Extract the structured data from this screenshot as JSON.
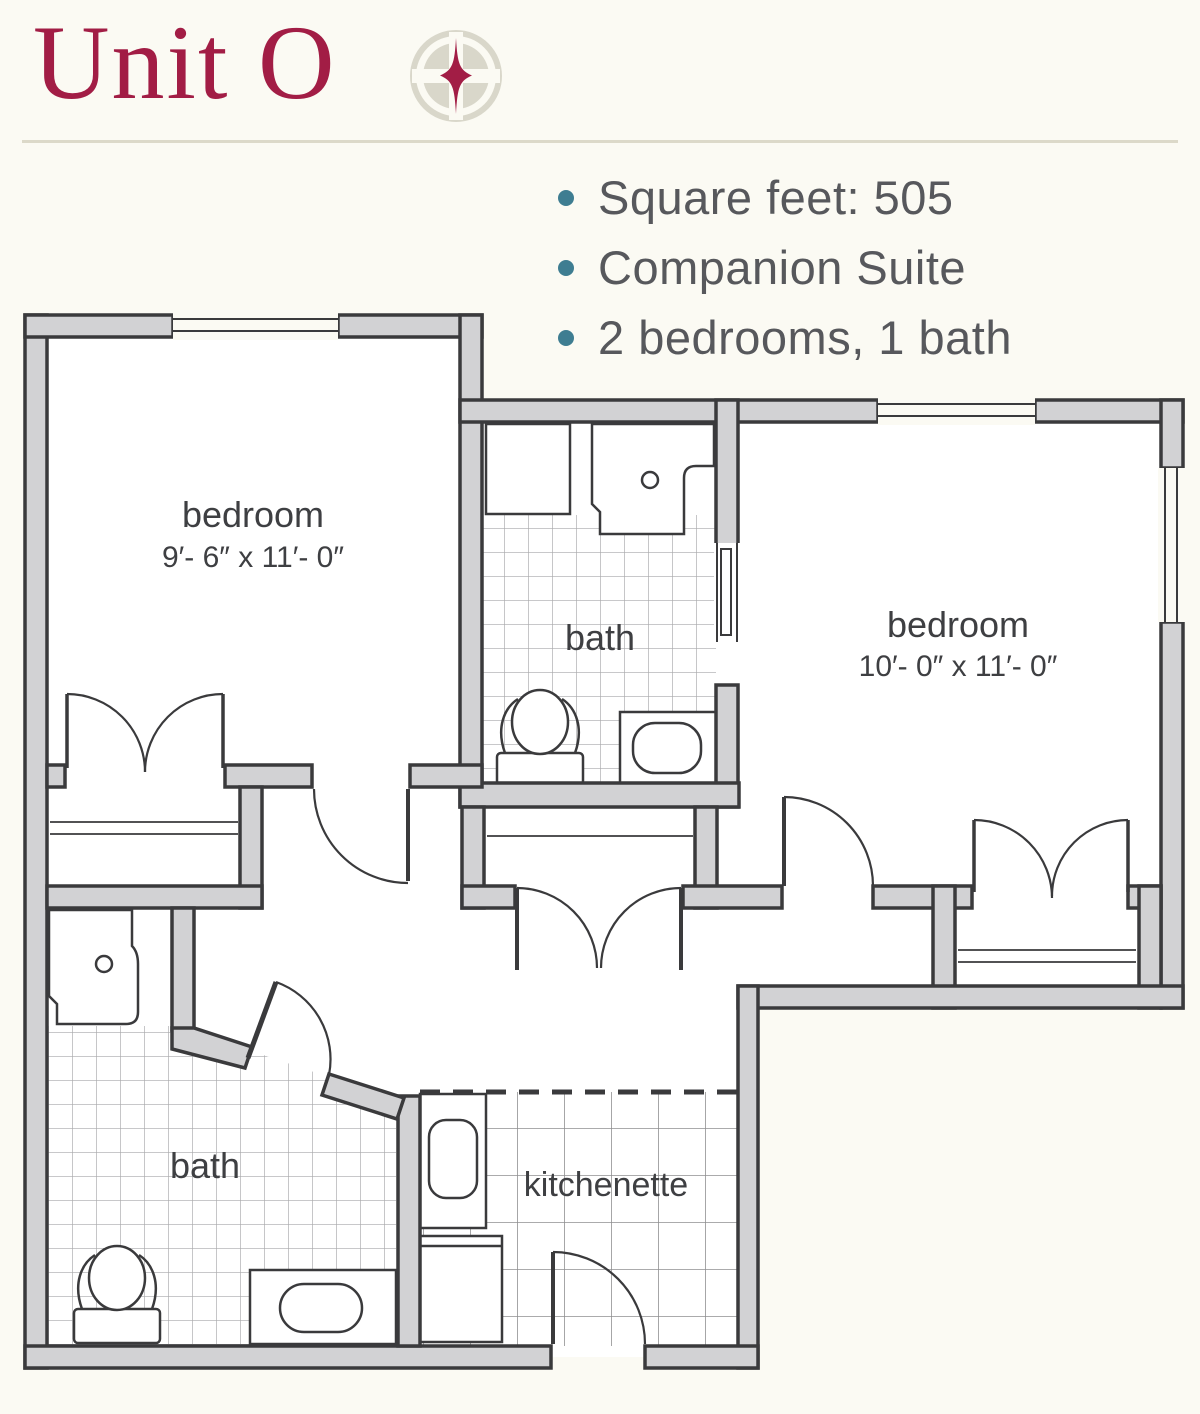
{
  "header": {
    "title": "Unit O",
    "logo": "petal-cross-logo"
  },
  "summary": {
    "items": [
      "Square feet: 505",
      "Companion Suite",
      "2 bedrooms, 1 bath"
    ]
  },
  "floor_plan": {
    "bedroom1": {
      "label": "bedroom",
      "dimensions": "9′- 6″ x 11′- 0″"
    },
    "bedroom2": {
      "label": "bedroom",
      "dimensions": "10′- 0″ x 11′- 0″"
    },
    "bath1": {
      "label": "bath"
    },
    "bath2": {
      "label": "bath"
    },
    "kitchenette": {
      "label": "kitchenette"
    }
  },
  "colors": {
    "accent_maroon": "#a21d45",
    "bullet_teal": "#3e7d91",
    "wall_gray": "#d2d2d4",
    "line_dark": "#3a3a3c",
    "background_cream": "#fbfaf3"
  }
}
